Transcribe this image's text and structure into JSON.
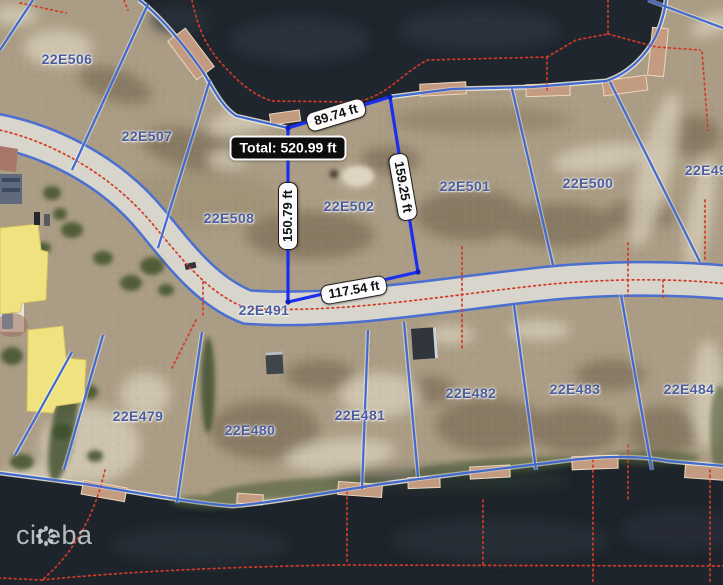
{
  "map": {
    "parcel_labels": [
      {
        "text": "22E506"
      },
      {
        "text": "22E507"
      },
      {
        "text": "22E508"
      },
      {
        "text": "22E502"
      },
      {
        "text": "22E501"
      },
      {
        "text": "22E500"
      },
      {
        "text": "22E49"
      },
      {
        "text": "22E491"
      },
      {
        "text": "22E479"
      },
      {
        "text": "22E480"
      },
      {
        "text": "22E481"
      },
      {
        "text": "22E482"
      },
      {
        "text": "22E483"
      },
      {
        "text": "22E484"
      }
    ],
    "measurements": {
      "top_edge": "89.74 ft",
      "right_edge": "159.25 ft",
      "left_edge": "150.79 ft",
      "bottom_edge": "117.54 ft",
      "total": "Total: 520.99 ft"
    },
    "watermark": "cireba",
    "colors": {
      "measured_outline": "#1b2ff2",
      "parcel_boundary": "#4169cf",
      "water_cadastral_dots": "#d23b28",
      "label_blue": "#4b5d9e"
    }
  }
}
